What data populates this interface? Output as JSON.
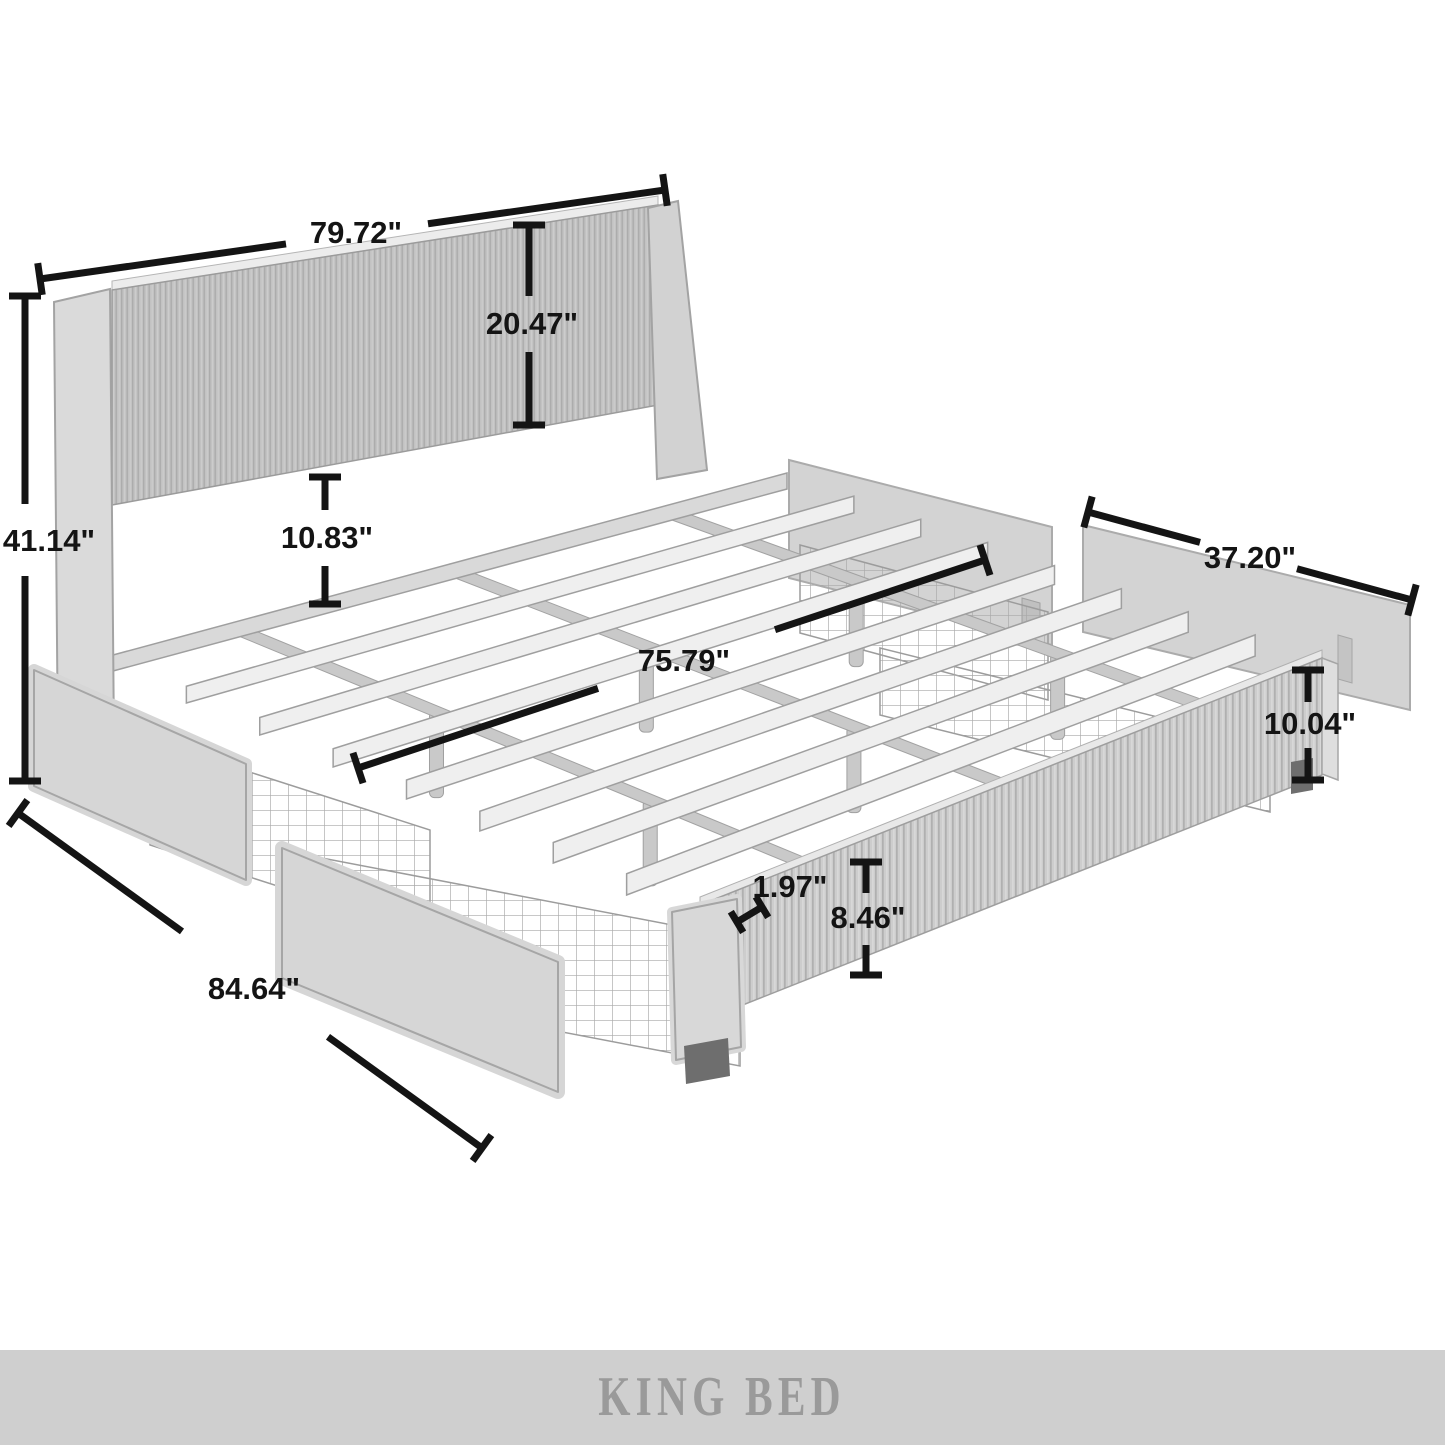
{
  "page": {
    "background": "#ffffff"
  },
  "banner": {
    "label": "KING BED",
    "background": "#cfcfcf",
    "text_color": "#9a9a9a"
  },
  "dimensions": {
    "headboard_width": "79.72\"",
    "headboard_panel_height": "20.47\"",
    "overall_height": "41.14\"",
    "headboard_to_slats_gap": "10.83\"",
    "side_panel_width": "37.20\"",
    "slat_length": "75.79\"",
    "side_drawer_end_height": "10.04\"",
    "slat_thickness": "1.97\"",
    "drawer_front_height": "8.46\"",
    "overall_length": "84.64\""
  },
  "annotation_color": "#141414",
  "bed_colors": {
    "headboard_panel": "#c2c2c2",
    "flute_shadow": "#acacac",
    "frame_light": "#efefef",
    "frame_mid": "#d6d6d6",
    "frame_dark": "#c9c9c9",
    "leg_dark": "#6e6e6e",
    "mesh_wire": "#a8a8a8",
    "outline": "#9f9f9f"
  }
}
